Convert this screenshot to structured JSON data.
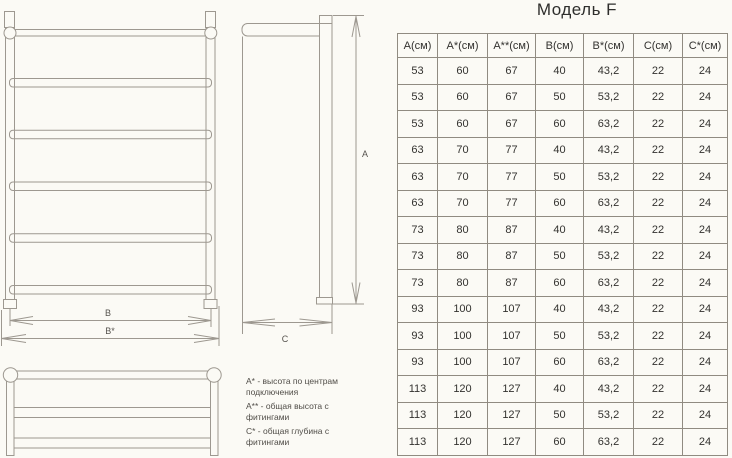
{
  "page": {
    "title": "Модель F"
  },
  "drawing": {
    "dimension_labels": {
      "a": "А",
      "b": "В",
      "b_star": "В*",
      "c": "С"
    },
    "legend": [
      "А* - высота по центрам подключения",
      "А** - общая высота с фитингами",
      "С* - общая глубина с фитингами"
    ]
  },
  "table": {
    "headers": [
      "А(см)",
      "А*(см)",
      "А**(см)",
      "В(см)",
      "В*(см)",
      "С(см)",
      "С*(см)"
    ],
    "rows": [
      [
        "53",
        "60",
        "67",
        "40",
        "43,2",
        "22",
        "24"
      ],
      [
        "53",
        "60",
        "67",
        "50",
        "53,2",
        "22",
        "24"
      ],
      [
        "53",
        "60",
        "67",
        "60",
        "63,2",
        "22",
        "24"
      ],
      [
        "63",
        "70",
        "77",
        "40",
        "43,2",
        "22",
        "24"
      ],
      [
        "63",
        "70",
        "77",
        "50",
        "53,2",
        "22",
        "24"
      ],
      [
        "63",
        "70",
        "77",
        "60",
        "63,2",
        "22",
        "24"
      ],
      [
        "73",
        "80",
        "87",
        "40",
        "43,2",
        "22",
        "24"
      ],
      [
        "73",
        "80",
        "87",
        "50",
        "53,2",
        "22",
        "24"
      ],
      [
        "73",
        "80",
        "87",
        "60",
        "63,2",
        "22",
        "24"
      ],
      [
        "93",
        "100",
        "107",
        "40",
        "43,2",
        "22",
        "24"
      ],
      [
        "93",
        "100",
        "107",
        "50",
        "53,2",
        "22",
        "24"
      ],
      [
        "93",
        "100",
        "107",
        "60",
        "63,2",
        "22",
        "24"
      ],
      [
        "113",
        "120",
        "127",
        "40",
        "43,2",
        "22",
        "24"
      ],
      [
        "113",
        "120",
        "127",
        "50",
        "53,2",
        "22",
        "24"
      ],
      [
        "113",
        "120",
        "127",
        "60",
        "63,2",
        "22",
        "24"
      ]
    ]
  }
}
